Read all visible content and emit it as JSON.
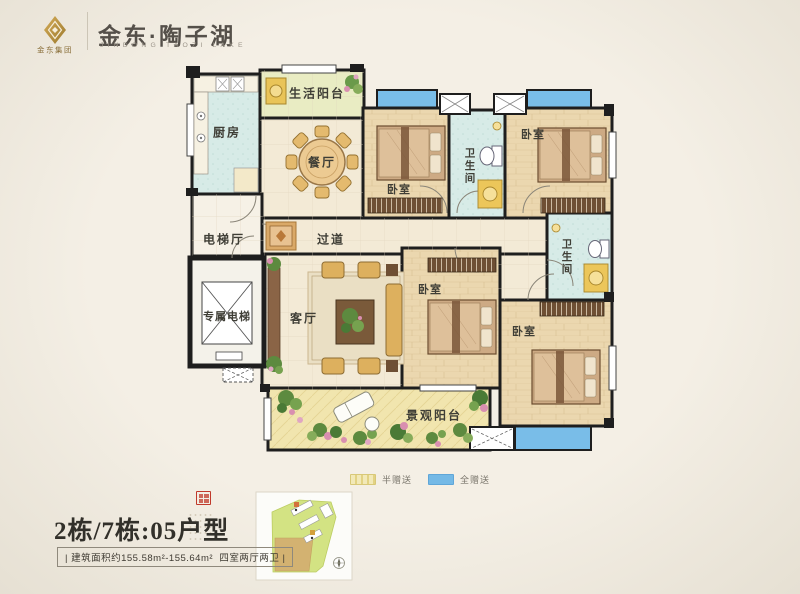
{
  "page": {
    "background": "#f1ece2"
  },
  "header": {
    "group_cn": "金东集团",
    "brand_cn": "金东·陶子湖",
    "brand_en": "JINDONG TAOZI LAKE",
    "gold": "#b68d3f"
  },
  "floorplan": {
    "rooms": {
      "kitchen": "厨房",
      "service_balcony": "生活阳台",
      "dining": "餐厅",
      "elevator_hall": "电梯厅",
      "corridor": "过道",
      "private_elevator": "专属电梯",
      "living": "客厅",
      "bedroom_top_left": "卧室",
      "bath_top": "卫生间",
      "bedroom_top_right": "卧室",
      "bath_right": "卫生间",
      "bedroom_mid": "卧室",
      "bedroom_bottom_right": "卧室",
      "view_balcony": "景观阳台"
    },
    "colors": {
      "wall": "#1e1e1e",
      "wood_floor": "#ebd7af",
      "tile_floor": "#f3ead6",
      "bath_floor": "#d7ebe7",
      "balcony_half_gift": "#e9ecc3",
      "balcony_full_gift": "#79bde8"
    }
  },
  "legend": {
    "items": [
      {
        "label": "半赠送",
        "color": "#efe6a8"
      },
      {
        "label": "全赠送",
        "color": "#74b9e6"
      }
    ]
  },
  "unit": {
    "name": "2栋/7栋:05户型",
    "spec": "| 建筑面积约155.58m²-155.64m²  四室两厅两卫 |"
  }
}
